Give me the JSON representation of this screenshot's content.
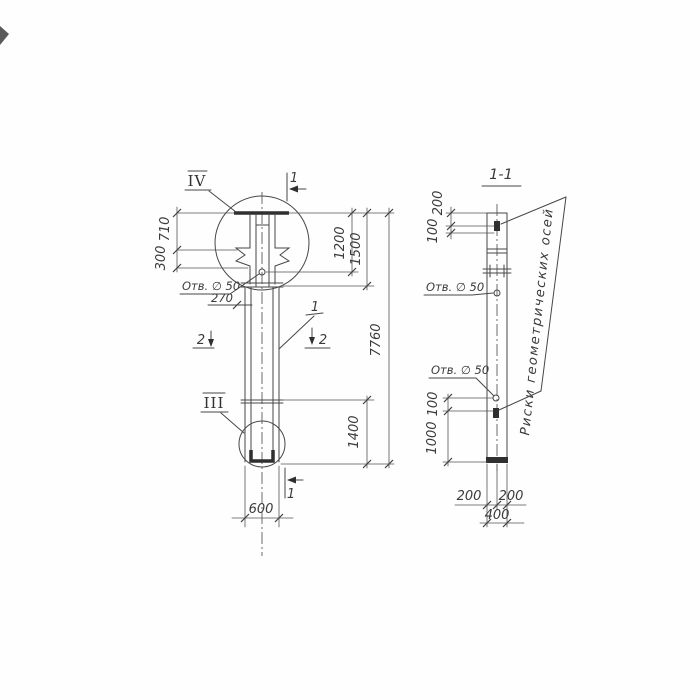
{
  "drawing": {
    "left_view": {
      "detail_marker_top": "IV",
      "detail_marker_bottom": "III",
      "section_mark_top": "1",
      "section_mark_bottom": "1",
      "section_mark_left": "2",
      "section_mark_right": "2",
      "part_leader": "1",
      "hole_label": "Отв. ∅ 50",
      "dim_710": "710",
      "dim_300": "300",
      "dim_270": "270",
      "dim_1200": "1200",
      "dim_1500": "1500",
      "dim_7760": "7760",
      "dim_1400": "1400",
      "dim_600": "600"
    },
    "section_view": {
      "title": "1-1",
      "hole_label_top": "Отв. ∅ 50",
      "hole_label_bottom": "Отв. ∅ 50",
      "axes_note": "Риски геометрических осей",
      "dim_200_top": "200",
      "dim_100_top": "100",
      "dim_100_bottom": "100",
      "dim_1000": "1000",
      "dim_200_left": "200",
      "dim_200_right": "200",
      "dim_400": "400"
    }
  }
}
